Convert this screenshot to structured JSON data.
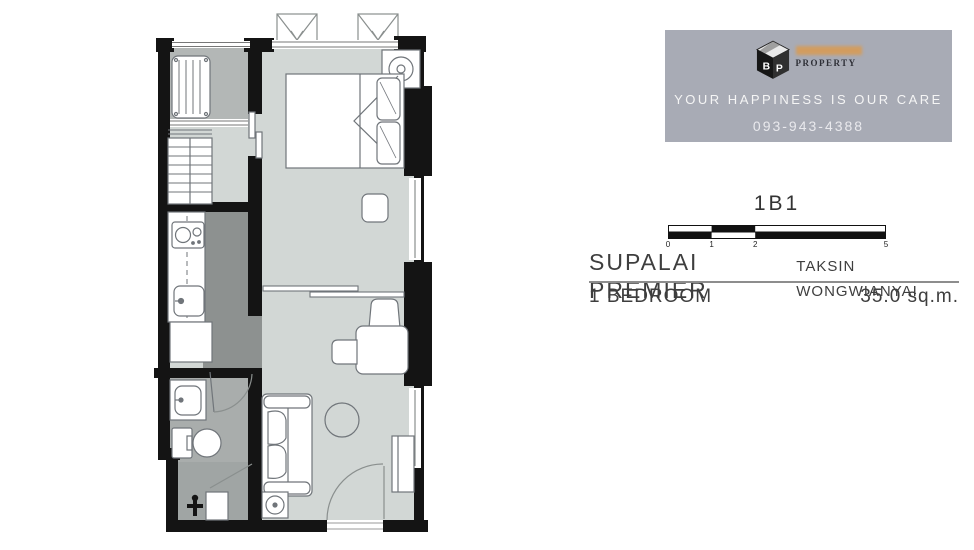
{
  "brand_panel": {
    "bg_color": "#a8abb5",
    "logo_sub": "PROPERTY",
    "tagline": "YOUR HAPPINESS IS OUR CARE",
    "phone": "093-943-4388",
    "brand_highlight_color": "#d79b55"
  },
  "unit": {
    "code": "1B1",
    "project": "SUPALAI PREMIER",
    "location": "TAKSIN WONGWIANYAI",
    "bedroom": "1 BEDROOM",
    "area": "35.0 sq.m."
  },
  "scale_bar": {
    "marks": [
      "0",
      "1",
      "2",
      "5"
    ]
  },
  "floor_plan": {
    "rooms": [
      "balcony",
      "bedroom",
      "wardrobe-nook",
      "kitchen",
      "bathroom",
      "utility",
      "living-dining"
    ],
    "furniture": [
      "ac-compressor-unit",
      "ac-units-ledge",
      "double-bed",
      "pillows",
      "nightstand-with-lamp",
      "stool",
      "wardrobe-shelves",
      "two-burner-stove",
      "kitchen-sink",
      "refrigerator",
      "kitchen-counter",
      "vanity-sink",
      "toilet",
      "utility-tap",
      "sofa",
      "side-table",
      "round-table",
      "desk",
      "desk-chair",
      "guest-chair",
      "shoe-cabinet",
      "entrance-door-swing",
      "bathroom-door-swing",
      "sliding-partition",
      "bedroom-sliding-door"
    ],
    "colors": {
      "wall": "#141414",
      "room_floor": "#d2d7d5",
      "balcony_floor": "#b3b7b6",
      "kitchen_floor": "#8d9190",
      "bathroom_floor": "#a9adac",
      "utility_floor": "#a0a5a4",
      "furniture_stroke": "#70757a"
    }
  }
}
